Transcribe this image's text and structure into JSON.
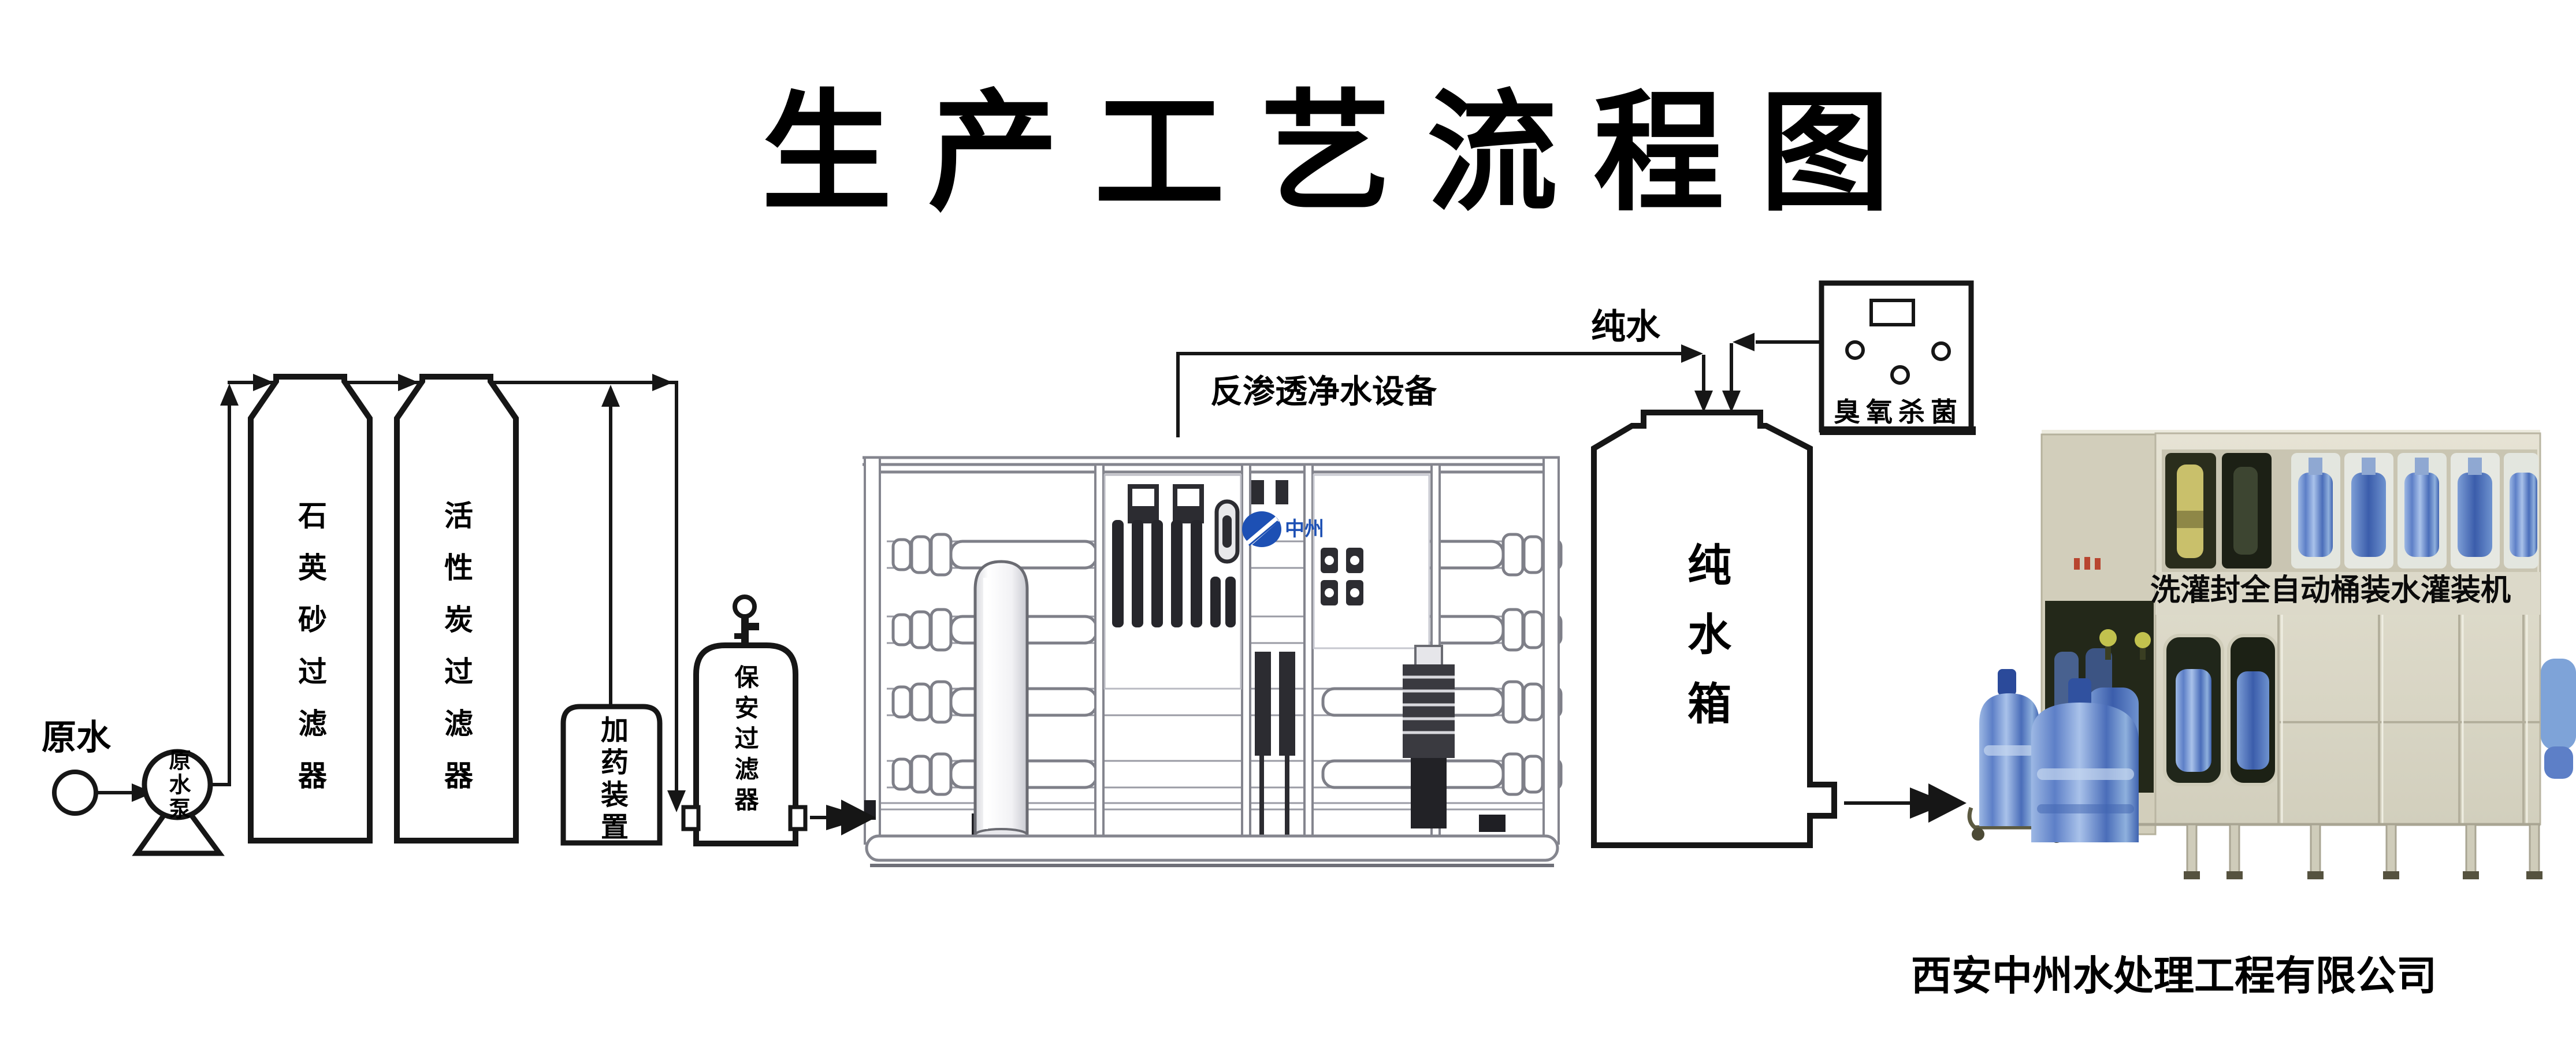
{
  "title": "生产工艺流程图",
  "flow": {
    "raw_water": "原水",
    "raw_water_pump": "原水泵",
    "quartz_sand_filter": "石英砂过滤器",
    "activated_carbon_filter": "活性炭过滤器",
    "dosing_device": "加药装置",
    "cartridge_filter": "保安过滤器",
    "ro_equipment": "反渗透净水设备",
    "pure_water": "纯水",
    "pure_water_tank": "纯水箱",
    "ozone_sterilizer": "臭氧杀菌"
  },
  "filling_machine": {
    "banner": "洗灌封全自动桶装水灌装机"
  },
  "brand": {
    "logo_text": "中州"
  },
  "footer": {
    "company": "西安中州水处理工程有限公司"
  },
  "colors": {
    "diagram_line": "#161616",
    "machine_stroke": "#84858e",
    "logo_blue": "#1d50b4",
    "bottle_blue": "#5d7fc7",
    "machine_cream": "#d9d6c5",
    "dark_window": "#20261a"
  }
}
